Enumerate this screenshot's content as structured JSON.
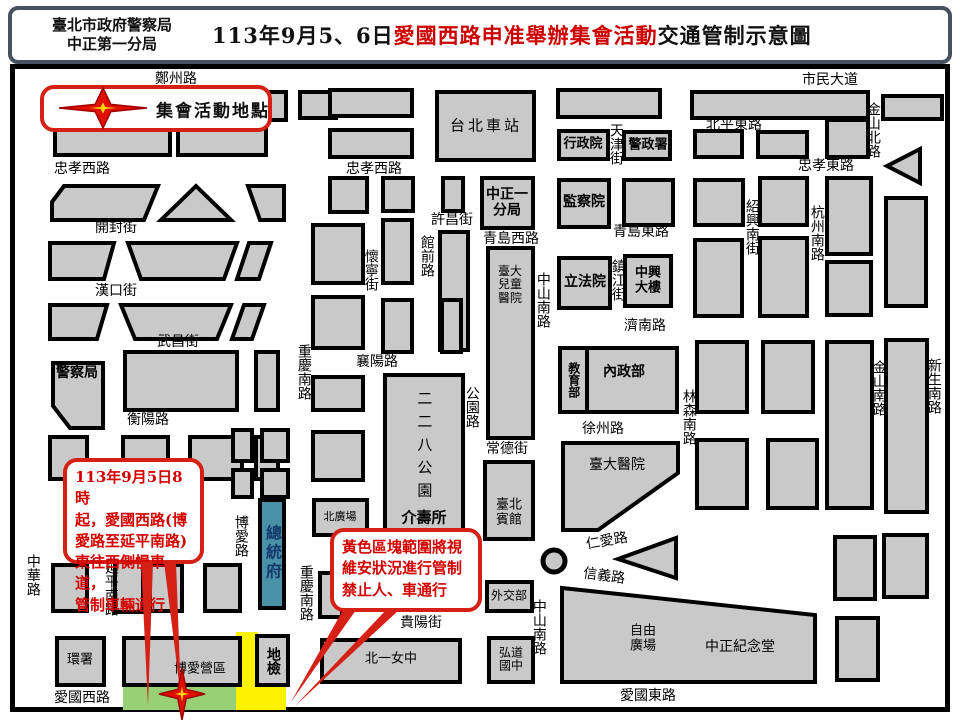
{
  "header": {
    "agency_line1": "臺北市政府警察局",
    "agency_line2": "中正第一分局",
    "title_prefix": "113年9月5、6日",
    "title_highlight": "愛國西路申准舉辦集會活動",
    "title_suffix": "交通管制示意圖"
  },
  "legend": {
    "label": "集會活動地點",
    "icon": "assembly-star-icon"
  },
  "callouts": [
    {
      "id": "west-lane-control",
      "text": "113年9月5日8時\n起，愛國西路(博\n愛路至延平南路)\n東往西側慢車道，\n管制車輛通行"
    },
    {
      "id": "yellow-zone-control",
      "text": "黃色區塊範圍將視\n維安狀況進行管制\n禁止人、車通行"
    }
  ],
  "colors": {
    "block_fill": "#c9c9c9",
    "block_stroke": "#000000",
    "presidential_fill": "#4a90a8",
    "presidential_text": "#123a6b",
    "green_zone": "#97d077",
    "yellow_zone": "#fef200",
    "callout_red": "#d42015",
    "title_red": "#cc0000",
    "star_red": "#e01000",
    "star_yellow": "#ffd700"
  },
  "map": {
    "theme": {
      "block_fill": "#c9c9c9",
      "block_stroke": "#000000",
      "callout_red": "#d42015",
      "star_red": "#e01000",
      "star_yellow": "#ffd700"
    },
    "roundabout": {
      "x": 554,
      "y": 561,
      "r": 11
    },
    "zones": [
      {
        "n": "assembly-green-zone",
        "fill": "#97d077",
        "x": 123,
        "y": 686,
        "w": 116,
        "h": 24
      },
      {
        "n": "security-yellow-zone",
        "fill": "#fef200",
        "pts": "236,632 258,632 258,684 286,684 286,710 236,710"
      }
    ],
    "stars": [
      {
        "n": "legend-star-marker",
        "x": 103,
        "y": 108,
        "rx": 44,
        "ry": 20
      },
      {
        "n": "assembly-location-star-marker",
        "x": 182,
        "y": 694,
        "rx": 23,
        "ry": 26
      }
    ],
    "tails": [
      "141,562 153,562 148,706",
      "164,562 176,562 181,698",
      "343,610 356,610 291,702",
      "386,610 399,610 295,706"
    ],
    "blocks": [
      {
        "x": 55,
        "y": 128,
        "w": 115,
        "h": 27
      },
      {
        "x": 178,
        "y": 128,
        "w": 88,
        "h": 27
      },
      {
        "x": 262,
        "y": 92,
        "w": 24,
        "h": 28
      },
      {
        "x": 300,
        "y": 92,
        "w": 36,
        "h": 26
      },
      {
        "pts": "52,202 64,186 158,186 144,220 52,220"
      },
      {
        "pts": "196,186 231,220 161,220"
      },
      {
        "pts": "248,186 284,186 284,220 260,220"
      },
      {
        "pts": "50,243 114,243 104,279 50,279"
      },
      {
        "pts": "128,243 237,243 224,279 141,279"
      },
      {
        "pts": "249,243 271,243 259,279 237,279"
      },
      {
        "pts": "50,305 107,305 97,339 50,339"
      },
      {
        "pts": "121,305 231,305 217,339 135,339"
      },
      {
        "pts": "244,305 264,305 252,339 232,339"
      },
      {
        "x": 125,
        "y": 352,
        "w": 112,
        "h": 58
      },
      {
        "x": 256,
        "y": 352,
        "w": 22,
        "h": 58
      },
      {
        "n": "police-hq-block",
        "pts": "53,363 103,363 103,428 70,428 53,406"
      },
      {
        "x": 123,
        "y": 437,
        "w": 45,
        "h": 42
      },
      {
        "x": 190,
        "y": 437,
        "w": 52,
        "h": 42
      },
      {
        "x": 256,
        "y": 437,
        "w": 22,
        "h": 42
      },
      {
        "x": 50,
        "y": 437,
        "w": 37,
        "h": 42
      },
      {
        "x": 53,
        "y": 565,
        "w": 34,
        "h": 46
      },
      {
        "x": 115,
        "y": 562,
        "w": 28,
        "h": 50
      },
      {
        "x": 150,
        "y": 565,
        "w": 32,
        "h": 46
      },
      {
        "x": 205,
        "y": 565,
        "w": 35,
        "h": 46
      },
      {
        "x": 233,
        "y": 430,
        "w": 19,
        "h": 31
      },
      {
        "x": 262,
        "y": 430,
        "w": 26,
        "h": 31
      },
      {
        "x": 233,
        "y": 470,
        "w": 19,
        "h": 27
      },
      {
        "x": 262,
        "y": 470,
        "w": 26,
        "h": 27
      },
      {
        "n": "presidential-office-block",
        "x": 260,
        "y": 500,
        "w": 24,
        "h": 108,
        "fill": "#4a90a8"
      },
      {
        "n": "epa-block",
        "x": 57,
        "y": 638,
        "w": 47,
        "h": 47
      },
      {
        "n": "boai-camp-block",
        "x": 124,
        "y": 638,
        "w": 116,
        "h": 47
      },
      {
        "n": "district-court-block",
        "x": 257,
        "y": 636,
        "w": 31,
        "h": 49
      },
      {
        "n": "first-girls-high-block",
        "x": 322,
        "y": 640,
        "w": 138,
        "h": 42
      },
      {
        "n": "hongdao-jhs-block",
        "x": 489,
        "y": 638,
        "w": 44,
        "h": 44
      },
      {
        "n": "foreign-ministry-block",
        "x": 487,
        "y": 582,
        "w": 45,
        "h": 29
      },
      {
        "n": "taipei-guest-house-block",
        "x": 485,
        "y": 462,
        "w": 48,
        "h": 77
      },
      {
        "n": "ntu-children-hospital-block",
        "x": 488,
        "y": 248,
        "w": 45,
        "h": 190
      },
      {
        "n": "taipei-main-station-block",
        "x": 437,
        "y": 92,
        "w": 97,
        "h": 68
      },
      {
        "x": 330,
        "y": 90,
        "w": 82,
        "h": 26
      },
      {
        "x": 330,
        "y": 130,
        "w": 82,
        "h": 27
      },
      {
        "x": 558,
        "y": 90,
        "w": 102,
        "h": 27
      },
      {
        "n": "executive-yuan-block",
        "x": 559,
        "y": 131,
        "w": 49,
        "h": 28
      },
      {
        "n": "npa-block",
        "x": 624,
        "y": 132,
        "w": 46,
        "h": 27
      },
      {
        "x": 330,
        "y": 178,
        "w": 37,
        "h": 34
      },
      {
        "x": 383,
        "y": 178,
        "w": 30,
        "h": 33
      },
      {
        "x": 443,
        "y": 178,
        "w": 20,
        "h": 33
      },
      {
        "n": "zhongzheng-precinct-block",
        "x": 482,
        "y": 178,
        "w": 51,
        "h": 50
      },
      {
        "n": "control-yuan-block",
        "x": 559,
        "y": 180,
        "w": 50,
        "h": 47
      },
      {
        "x": 624,
        "y": 180,
        "w": 49,
        "h": 45
      },
      {
        "x": 695,
        "y": 180,
        "w": 48,
        "h": 45
      },
      {
        "x": 760,
        "y": 178,
        "w": 47,
        "h": 47
      },
      {
        "x": 827,
        "y": 178,
        "w": 44,
        "h": 76
      },
      {
        "x": 827,
        "y": 262,
        "w": 44,
        "h": 53
      },
      {
        "x": 886,
        "y": 198,
        "w": 40,
        "h": 108
      },
      {
        "x": 692,
        "y": 92,
        "w": 176,
        "h": 26
      },
      {
        "x": 695,
        "y": 131,
        "w": 47,
        "h": 26
      },
      {
        "x": 758,
        "y": 132,
        "w": 49,
        "h": 25
      },
      {
        "x": 827,
        "y": 120,
        "w": 41,
        "h": 37
      },
      {
        "x": 883,
        "y": 96,
        "w": 59,
        "h": 23
      },
      {
        "n": "direction-arrow",
        "pts": "887,166 920,149 920,183"
      },
      {
        "x": 313,
        "y": 225,
        "w": 50,
        "h": 58
      },
      {
        "x": 313,
        "y": 297,
        "w": 50,
        "h": 51
      },
      {
        "x": 313,
        "y": 377,
        "w": 50,
        "h": 33
      },
      {
        "x": 313,
        "y": 432,
        "w": 50,
        "h": 48
      },
      {
        "x": 383,
        "y": 220,
        "w": 29,
        "h": 63
      },
      {
        "x": 440,
        "y": 232,
        "w": 28,
        "h": 118
      },
      {
        "x": 383,
        "y": 300,
        "w": 29,
        "h": 52
      },
      {
        "x": 442,
        "y": 300,
        "w": 19,
        "h": 52
      },
      {
        "n": "228-park-block",
        "x": 385,
        "y": 375,
        "w": 78,
        "h": 168
      },
      {
        "n": "north-plaza-block",
        "x": 314,
        "y": 500,
        "w": 53,
        "h": 35
      },
      {
        "x": 320,
        "y": 573,
        "w": 22,
        "h": 44
      },
      {
        "n": "legislative-yuan-block",
        "x": 559,
        "y": 258,
        "w": 51,
        "h": 50
      },
      {
        "n": "zhongxing-building-block",
        "x": 625,
        "y": 256,
        "w": 46,
        "h": 50
      },
      {
        "x": 695,
        "y": 240,
        "w": 47,
        "h": 76
      },
      {
        "x": 760,
        "y": 238,
        "w": 47,
        "h": 78
      },
      {
        "n": "education-ministry-block",
        "x": 560,
        "y": 348,
        "w": 27,
        "h": 64
      },
      {
        "n": "interior-ministry-block",
        "x": 587,
        "y": 348,
        "w": 90,
        "h": 64
      },
      {
        "x": 697,
        "y": 342,
        "w": 50,
        "h": 70
      },
      {
        "x": 763,
        "y": 342,
        "w": 50,
        "h": 70
      },
      {
        "x": 827,
        "y": 342,
        "w": 45,
        "h": 166
      },
      {
        "x": 886,
        "y": 340,
        "w": 41,
        "h": 172
      },
      {
        "x": 697,
        "y": 440,
        "w": 50,
        "h": 68
      },
      {
        "x": 768,
        "y": 440,
        "w": 49,
        "h": 68
      },
      {
        "n": "ntu-hospital-block",
        "pts": "563,443 678,443 678,473 598,530 563,530"
      },
      {
        "pts": "618,559 676,538 676,578"
      },
      {
        "n": "cks-memorial-block",
        "pts": "562,588 815,615 815,682 562,682"
      },
      {
        "x": 835,
        "y": 537,
        "w": 40,
        "h": 62
      },
      {
        "x": 884,
        "y": 535,
        "w": 43,
        "h": 62
      },
      {
        "x": 837,
        "y": 618,
        "w": 41,
        "h": 62
      }
    ],
    "labels": [
      {
        "n": "street-label",
        "t": "鄭州路",
        "x": 176,
        "y": 80
      },
      {
        "n": "street-label",
        "t": "市民大道",
        "x": 830,
        "y": 81
      },
      {
        "n": "street-label",
        "t": "北平東路",
        "x": 734,
        "y": 126
      },
      {
        "n": "street-label",
        "t": "忠孝西路",
        "x": 82,
        "y": 170
      },
      {
        "n": "street-label",
        "t": "忠孝西路",
        "x": 374,
        "y": 170
      },
      {
        "n": "street-label",
        "t": "忠孝東路",
        "x": 826,
        "y": 167
      },
      {
        "n": "street-label",
        "t": "金山北路",
        "x": 872,
        "y": 130,
        "v": 1
      },
      {
        "n": "street-label",
        "t": "天津街",
        "x": 615,
        "y": 144,
        "v": 1
      },
      {
        "n": "street-label",
        "t": "開封街",
        "x": 116,
        "y": 229
      },
      {
        "n": "street-label",
        "t": "許昌街",
        "x": 452,
        "y": 221
      },
      {
        "n": "street-label",
        "t": "青島西路",
        "x": 511,
        "y": 240
      },
      {
        "n": "street-label",
        "t": "青島東路",
        "x": 641,
        "y": 233
      },
      {
        "n": "street-label",
        "t": "漢口街",
        "x": 116,
        "y": 292
      },
      {
        "n": "street-label",
        "t": "懷寧街",
        "x": 370,
        "y": 270,
        "v": 1
      },
      {
        "n": "street-label",
        "t": "館前路",
        "x": 426,
        "y": 256,
        "v": 1
      },
      {
        "n": "street-label",
        "t": "紹興南街",
        "x": 751,
        "y": 227,
        "v": 1
      },
      {
        "n": "street-label",
        "t": "杭州南路",
        "x": 816,
        "y": 233,
        "v": 1
      },
      {
        "n": "street-label",
        "t": "鎮江街",
        "x": 617,
        "y": 280,
        "v": 1
      },
      {
        "n": "street-label",
        "t": "武昌街",
        "x": 178,
        "y": 343
      },
      {
        "n": "street-label",
        "t": "中山南路",
        "x": 542,
        "y": 300,
        "v": 1
      },
      {
        "n": "street-label",
        "t": "濟南路",
        "x": 645,
        "y": 327
      },
      {
        "n": "street-label",
        "t": "襄陽路",
        "x": 377,
        "y": 363
      },
      {
        "n": "street-label",
        "t": "重慶南路",
        "x": 303,
        "y": 372,
        "v": 1
      },
      {
        "n": "street-label",
        "t": "衡陽路",
        "x": 148,
        "y": 421
      },
      {
        "n": "street-label",
        "t": "公園路",
        "x": 471,
        "y": 407,
        "v": 1
      },
      {
        "n": "street-label",
        "t": "徐州路",
        "x": 603,
        "y": 430
      },
      {
        "n": "street-label",
        "t": "林森南路",
        "x": 688,
        "y": 417,
        "v": 1
      },
      {
        "n": "street-label",
        "t": "金山南路",
        "x": 878,
        "y": 388,
        "v": 1
      },
      {
        "n": "street-label",
        "t": "新生南路",
        "x": 933,
        "y": 386,
        "v": 1
      },
      {
        "n": "street-label",
        "t": "常德街",
        "x": 507,
        "y": 450
      },
      {
        "n": "street-label",
        "t": "中華路",
        "x": 32,
        "y": 575,
        "v": 1
      },
      {
        "n": "street-label",
        "t": "延平南路",
        "x": 110,
        "y": 588,
        "v": 1
      },
      {
        "n": "street-label",
        "t": "博愛路",
        "x": 240,
        "y": 536,
        "v": 1
      },
      {
        "n": "street-label",
        "t": "重慶南路",
        "x": 305,
        "y": 593,
        "v": 1
      },
      {
        "n": "street-label",
        "t": "貴陽街",
        "x": 421,
        "y": 624
      },
      {
        "n": "street-label",
        "t": "中山南路",
        "x": 538,
        "y": 627,
        "v": 1
      },
      {
        "n": "street-label",
        "t": "仁愛路",
        "x": 607,
        "y": 542,
        "rot": -10
      },
      {
        "n": "street-label",
        "t": "信義路",
        "x": 604,
        "y": 577,
        "rot": 8
      },
      {
        "n": "street-label",
        "t": "愛國西路",
        "x": 82,
        "y": 699
      },
      {
        "n": "street-label",
        "t": "愛國東路",
        "x": 648,
        "y": 697
      },
      {
        "n": "police-hq-label",
        "t": "警察局",
        "x": 77,
        "y": 374,
        "b": 1
      },
      {
        "n": "taipei-main-station-label",
        "t": "台北車站",
        "x": 486,
        "y": 126,
        "s": 15,
        "ls": 3
      },
      {
        "n": "executive-yuan-label",
        "t": "行政院",
        "x": 583,
        "y": 145,
        "b": 1,
        "s": 13
      },
      {
        "n": "npa-label",
        "t": "警政署",
        "x": 648,
        "y": 146,
        "b": 1,
        "s": 13
      },
      {
        "n": "zhongzheng-precinct-label",
        "t": "中正一\n分局",
        "x": 507,
        "y": 203,
        "b": 1
      },
      {
        "n": "control-yuan-label",
        "t": "監察院",
        "x": 584,
        "y": 203,
        "b": 1
      },
      {
        "n": "legislative-yuan-label",
        "t": "立法院",
        "x": 585,
        "y": 283,
        "b": 1
      },
      {
        "n": "zhongxing-building-label",
        "t": "中興\n大樓",
        "x": 648,
        "y": 281,
        "b": 1,
        "s": 13
      },
      {
        "n": "ntu-children-hospital-label",
        "t": "臺大\n兒童\n醫院",
        "x": 510,
        "y": 285,
        "s": 12
      },
      {
        "n": "education-ministry-label",
        "t": "教育部",
        "x": 573,
        "y": 380,
        "b": 1,
        "s": 12,
        "v": 1
      },
      {
        "n": "interior-ministry-label",
        "t": "內政部",
        "x": 624,
        "y": 373,
        "b": 1
      },
      {
        "n": "228-park-label",
        "t": "二二八公園",
        "x": 424,
        "y": 448,
        "v": 1,
        "s": 15,
        "ls": 8
      },
      {
        "n": "jieshou-office-label",
        "t": "介壽所",
        "x": 424,
        "y": 518,
        "b": 1,
        "s": 15
      },
      {
        "n": "taipei-guest-house-label",
        "t": "臺北\n賓館",
        "x": 509,
        "y": 513,
        "s": 13
      },
      {
        "n": "ntu-hospital-label",
        "t": "臺大醫院",
        "x": 617,
        "y": 466
      },
      {
        "n": "presidential-office-label",
        "t": "總統府",
        "x": 272,
        "y": 553,
        "v": 1,
        "b": 1,
        "s": 16,
        "c": "#123a6b",
        "ls": 3
      },
      {
        "n": "north-plaza-label",
        "t": "北廣場",
        "x": 340,
        "y": 517,
        "s": 11
      },
      {
        "n": "foreign-ministry-label",
        "t": "外交部",
        "x": 509,
        "y": 596,
        "s": 12
      },
      {
        "n": "hongdao-jhs-label",
        "t": "弘道\n國中",
        "x": 511,
        "y": 660,
        "s": 12
      },
      {
        "n": "first-girls-high-label",
        "t": "北一女中",
        "x": 391,
        "y": 660,
        "s": 13
      },
      {
        "n": "liberty-square-label",
        "t": "自由\n廣場",
        "x": 643,
        "y": 639,
        "s": 13
      },
      {
        "n": "cks-memorial-label",
        "t": "中正紀念堂",
        "x": 740,
        "y": 648
      },
      {
        "n": "epa-label",
        "t": "環署",
        "x": 80,
        "y": 661,
        "s": 13
      },
      {
        "n": "boai-camp-label",
        "t": "博愛營區",
        "x": 200,
        "y": 670,
        "s": 13
      },
      {
        "n": "district-court-label",
        "t": "地檢",
        "x": 272,
        "y": 661,
        "v": 1,
        "b": 1,
        "s": 14
      }
    ]
  }
}
